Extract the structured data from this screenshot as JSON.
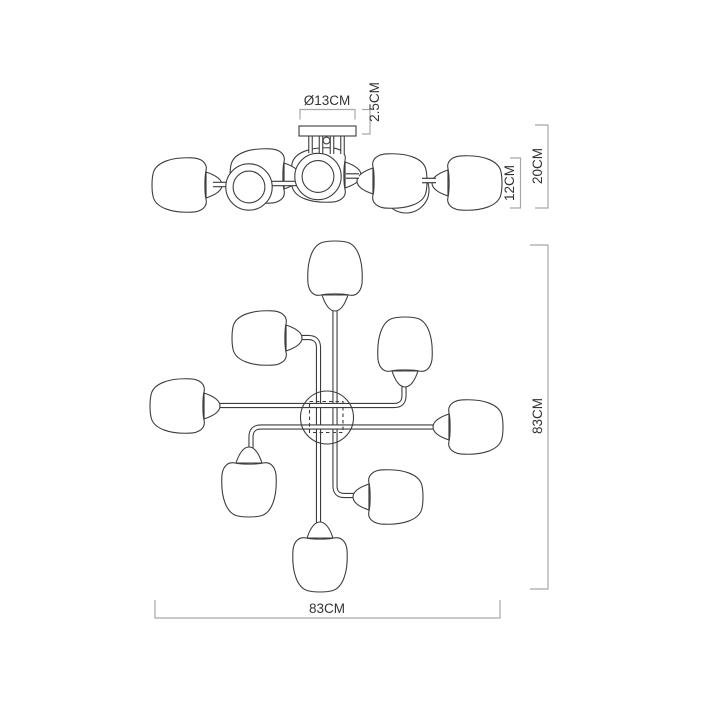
{
  "drawing": {
    "title": "ceiling-lamp-dimension-diagram",
    "side_view": {
      "diameter_label": "Ø13CM",
      "plate_height_label": "2.5CM",
      "shade_height_label": "12CM",
      "total_height_label": "20CM"
    },
    "plan_view": {
      "height_label": "83CM",
      "width_label": "83CM"
    },
    "colors": {
      "outline": "#3d3d3d",
      "dimension_line": "#a6a6a6",
      "label_text": "#333333",
      "background": "#ffffff"
    }
  }
}
